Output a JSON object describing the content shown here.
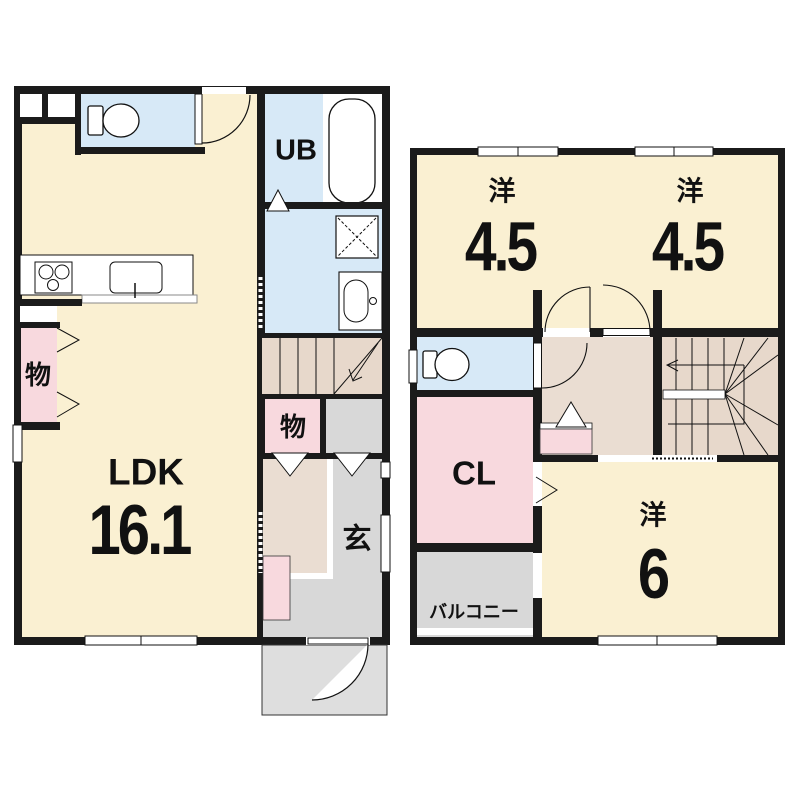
{
  "plan_title": "2-story house floor plan",
  "colors": {
    "wall": "#1b1b1b",
    "room_cream": "#FAF0D2",
    "wet_blue": "#D7E9F7",
    "storage_pink": "#F8D9DE",
    "hall_greige": "#EADDD2",
    "stairs_greige": "#E7D8CB",
    "entrance_gray": "#D8D8D8",
    "porch_gray": "#DEDEDE",
    "fixture_white": "#FFFFFF"
  },
  "floor1": {
    "ldk": {
      "label": "LDK",
      "size": "16.1"
    },
    "unit_bath": {
      "label": "UB"
    },
    "storage_left": {
      "label": "物"
    },
    "storage_hall": {
      "label": "物"
    },
    "entrance": {
      "label": "玄"
    },
    "fixtures": [
      "toilet-icon",
      "bathtub-icon",
      "washer-pan-icon",
      "washbasin-icon",
      "stove-icon",
      "kitchen-sink-icon",
      "stairs-up-icon",
      "entry-door-arc"
    ]
  },
  "floor2": {
    "west_room_1": {
      "label": "洋",
      "size": "4.5"
    },
    "west_room_2": {
      "label": "洋",
      "size": "4.5"
    },
    "closet": {
      "label": "CL"
    },
    "west_room_3": {
      "label": "洋",
      "size": "6"
    },
    "balcony": {
      "label": "バルコニー"
    },
    "fixtures": [
      "toilet-icon",
      "stairs-winder-icon",
      "balcony-door-arc",
      "double-door-arcs"
    ]
  }
}
